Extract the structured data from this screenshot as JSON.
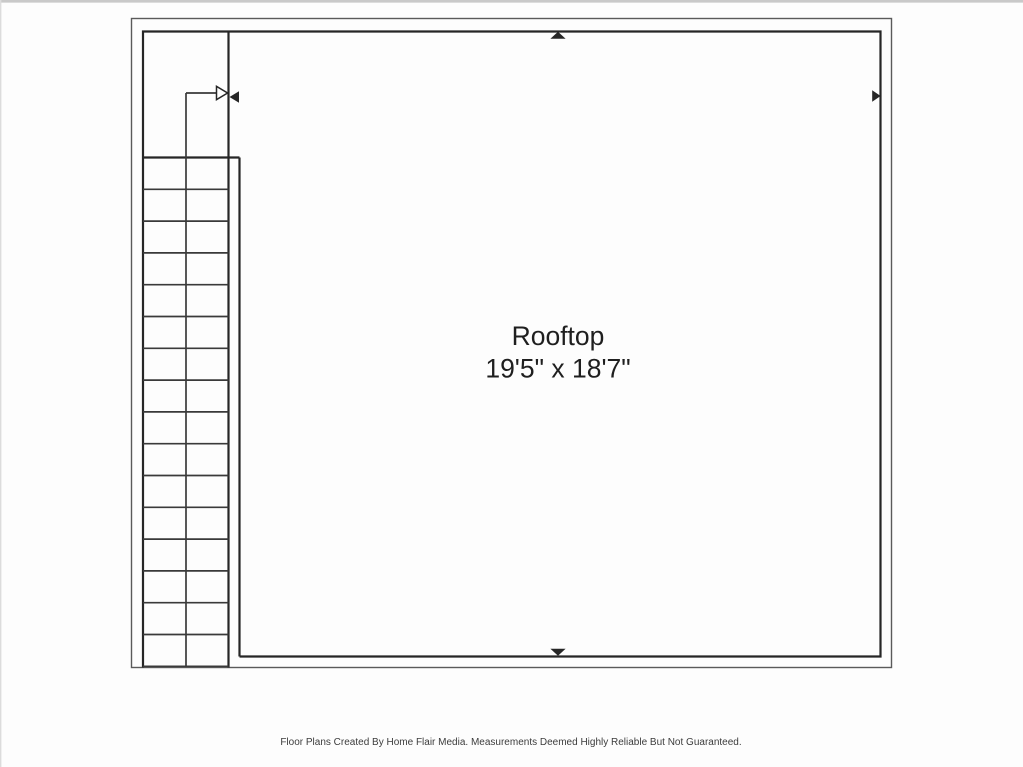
{
  "page": {
    "background": "#fdfdfd",
    "top_edge_color": "#c9c9c9",
    "left_edge_color": "#dcdcdc"
  },
  "floorplan": {
    "room": {
      "name": "Rooftop",
      "dimensions": "19'5\" x 18'7\""
    },
    "stairs": {
      "step_cells": 16,
      "direction": "up-toward-room"
    },
    "dimension_markers": [
      "top",
      "right",
      "bottom",
      "left"
    ],
    "footer": "Floor Plans Created By Home Flair Media. Measurements Deemed Highly Reliable But Not Guaranteed.",
    "colors": {
      "wall": "#262626",
      "outer_wall": "#5a5a5a",
      "step_line": "#3a3a3a",
      "label_text": "#1f1f1f",
      "footer_text": "#3c3c3c"
    }
  }
}
